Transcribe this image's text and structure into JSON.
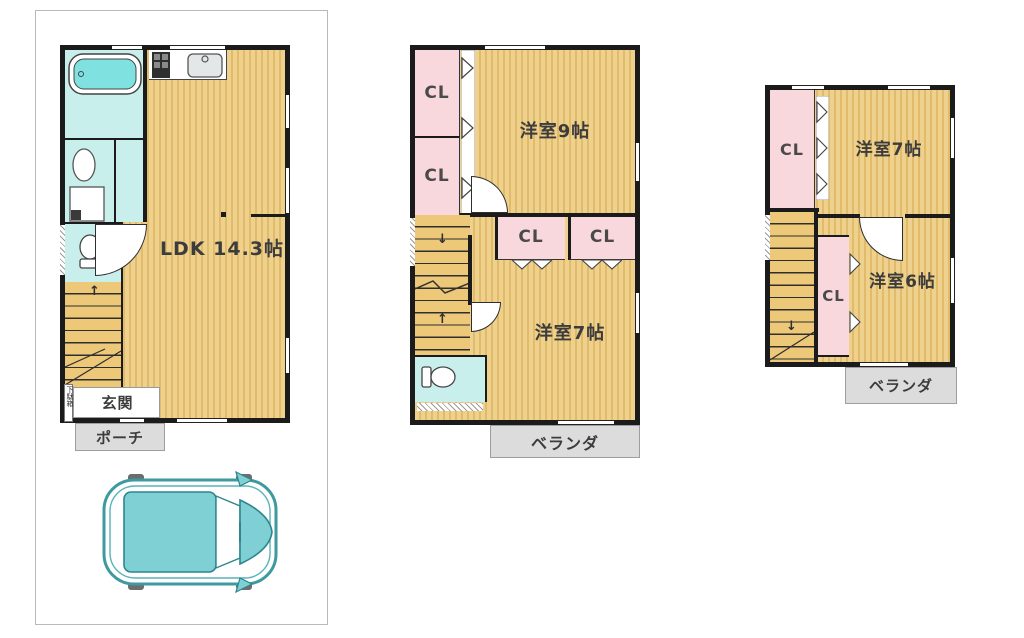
{
  "palette": {
    "wall": "#1b1b1b",
    "floor_yellow": "#ecc878",
    "closet_pink": "#f8d8dc",
    "wet_area_teal": "#c9efec",
    "bathtub_teal": "#7fe2e0",
    "outdoor_gray": "#dcdcdc",
    "car_teal": "#7fd0d4"
  },
  "icons": {
    "up_arrow": "↑",
    "down_arrow": "↓"
  },
  "floor1": {
    "ldk": "LDK 14.3帖",
    "genkan": "玄関",
    "porch": "ポーチ",
    "shoe_cabinet": "下駄箱"
  },
  "floor2": {
    "room_a": "洋室9帖",
    "room_b": "洋室7帖",
    "closets": [
      "CL",
      "CL",
      "CL",
      "CL"
    ],
    "veranda": "ベランダ"
  },
  "floor3": {
    "room_a": "洋室7帖",
    "room_b": "洋室6帖",
    "closets": [
      "CL",
      "CL"
    ],
    "veranda": "ベランダ"
  }
}
